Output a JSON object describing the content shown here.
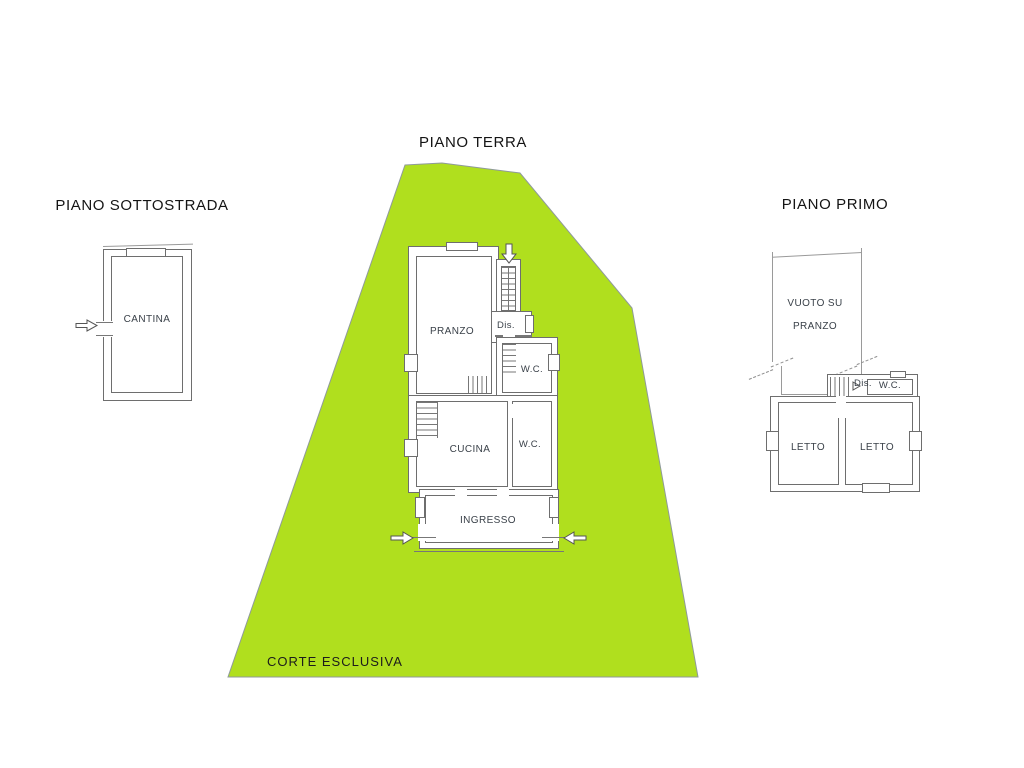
{
  "courtyard": {
    "label": "CORTE ESCLUSIVA",
    "fill_color": "#b0df1e",
    "outline_color": "#8f9a9a"
  },
  "floors": {
    "basement": {
      "title": "PIANO SOTTOSTRADA",
      "rooms": {
        "cantina": "CANTINA"
      }
    },
    "ground": {
      "title": "PIANO TERRA",
      "rooms": {
        "pranzo": "PRANZO",
        "dis": "Dis.",
        "wc_top": "W.C.",
        "cucina": "CUCINA",
        "wc_bottom": "W.C.",
        "ingresso": "INGRESSO"
      }
    },
    "first": {
      "title": "PIANO PRIMO",
      "rooms": {
        "vuoto_line1": "VUOTO SU",
        "vuoto_line2": "PRANZO",
        "dis": "Dis.",
        "wc": "W.C.",
        "letto_left": "LETTO",
        "letto_right": "LETTO"
      }
    }
  }
}
